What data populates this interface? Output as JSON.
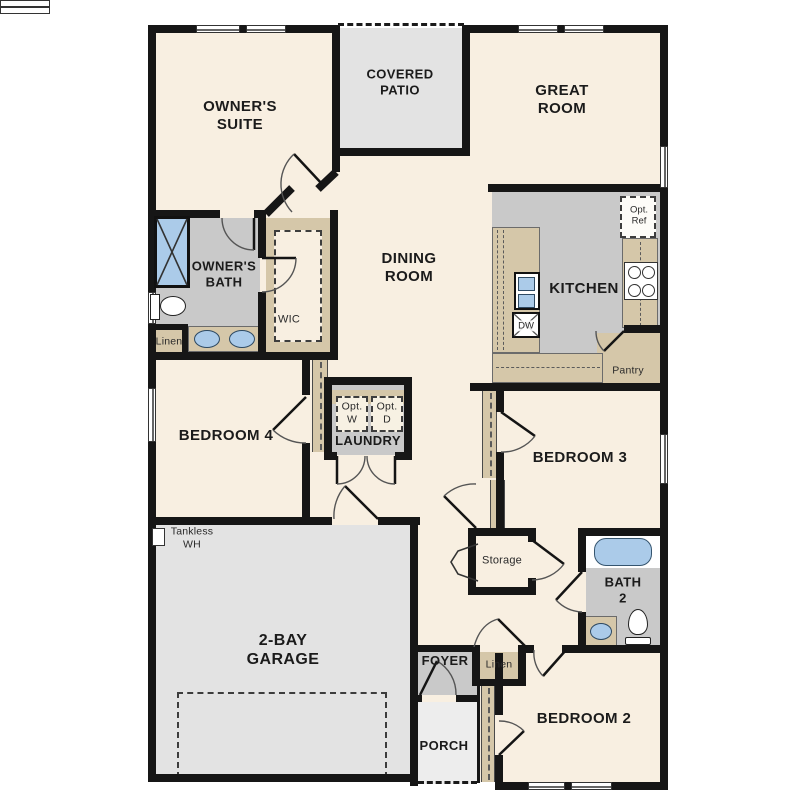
{
  "plan_type": "single-story floor plan",
  "palette": {
    "floor_main": "#f8efe1",
    "floor_wet": "#c9c9c9",
    "floor_outdoor_garage": "#e3e3e3",
    "floor_porch": "#ededed",
    "cabinet_tan": "#d5c7a9",
    "fixture_blue": "#abcbe9",
    "wall": "#161616"
  },
  "rooms": [
    {
      "id": "owners-suite",
      "label": "OWNER'S\nSUITE"
    },
    {
      "id": "covered-patio",
      "label": "COVERED\nPATIO"
    },
    {
      "id": "great-room",
      "label": "GREAT\nROOM"
    },
    {
      "id": "owners-bath",
      "label": "OWNER'S\nBATH"
    },
    {
      "id": "linen-bath",
      "label": "Linen"
    },
    {
      "id": "wic",
      "label": "WIC"
    },
    {
      "id": "dining-room",
      "label": "DINING\nROOM"
    },
    {
      "id": "kitchen",
      "label": "KITCHEN"
    },
    {
      "id": "dishwasher",
      "label": "DW"
    },
    {
      "id": "opt-ref",
      "label": "Opt.\nRef"
    },
    {
      "id": "pantry",
      "label": "Pantry"
    },
    {
      "id": "bedroom-4",
      "label": "BEDROOM 4"
    },
    {
      "id": "opt-washer",
      "label": "Opt.\nW"
    },
    {
      "id": "opt-dryer",
      "label": "Opt.\nD"
    },
    {
      "id": "laundry",
      "label": "LAUNDRY"
    },
    {
      "id": "bedroom-3",
      "label": "BEDROOM 3"
    },
    {
      "id": "storage",
      "label": "Storage"
    },
    {
      "id": "tankless-wh",
      "label": "Tankless\nWH"
    },
    {
      "id": "garage",
      "label": "2-BAY\nGARAGE"
    },
    {
      "id": "bath-2",
      "label": "BATH\n2"
    },
    {
      "id": "foyer",
      "label": "FOYER"
    },
    {
      "id": "linen-hall",
      "label": "Linen"
    },
    {
      "id": "porch",
      "label": "PORCH"
    },
    {
      "id": "bedroom-2",
      "label": "BEDROOM 2"
    }
  ],
  "fixtures": [
    "shower",
    "toilet",
    "double-vanity-sinks",
    "kitchen-sink",
    "dishwasher",
    "range",
    "bathtub",
    "bath-sink",
    "tankless-water-heater",
    "garage-door",
    "sliding-patio-door"
  ]
}
